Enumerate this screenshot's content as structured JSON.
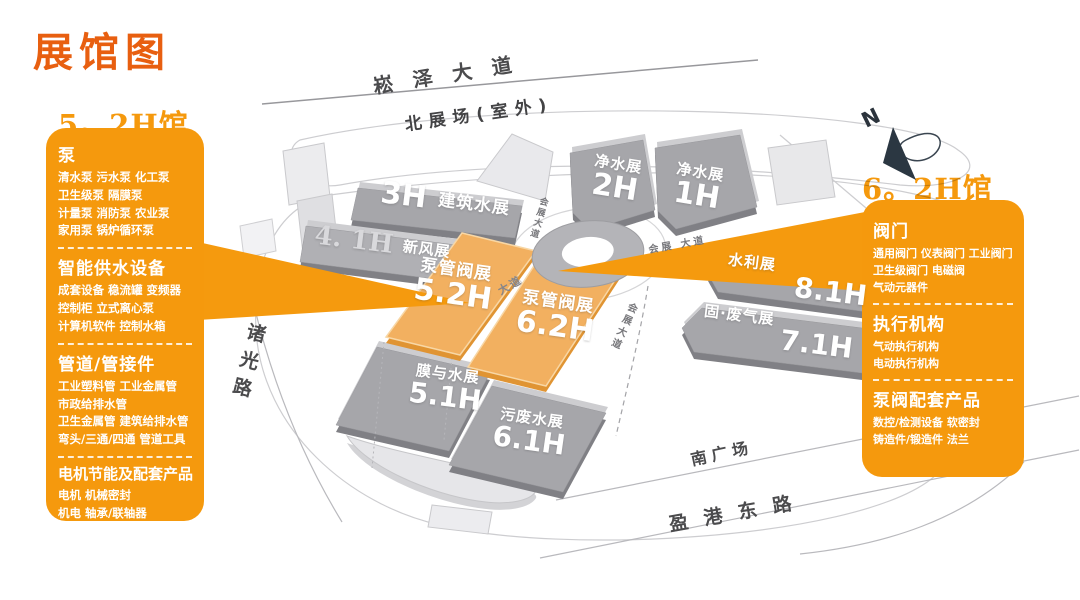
{
  "title": "展馆图",
  "colors": {
    "accent_orange": "#f5990d",
    "highlight_hall_orange": "#f2b060",
    "hall_gray": "#a6a6aa",
    "title_orange": "#e85f10"
  },
  "left_panel": {
    "heading": "5。2H馆",
    "sections": [
      {
        "header": "泵",
        "lines": [
          "清水泵 污水泵 化工泵",
          "卫生级泵 隔膜泵",
          "计量泵 消防泵 农业泵",
          "家用泵 锅炉循环泵"
        ]
      },
      {
        "header": "智能供水设备",
        "lines": [
          "成套设备 稳流罐 变频器",
          "控制柜 立式离心泵",
          "计算机软件 控制水箱"
        ]
      },
      {
        "header": "管道/管接件",
        "lines": [
          "工业塑料管 工业金属管",
          "市政给排水管",
          "卫生金属管 建筑给排水管",
          "弯头/三通/四通 管道工具"
        ]
      },
      {
        "header": "电机节能及配套产品",
        "lines": [
          "电机 机械密封",
          "机电 轴承/联轴器"
        ]
      }
    ]
  },
  "right_panel": {
    "heading": "6。2H馆",
    "sections": [
      {
        "header": "阀门",
        "lines": [
          "通用阀门 仪表阀门 工业阀门",
          "卫生级阀门 电磁阀",
          "气动元器件"
        ]
      },
      {
        "header": "执行机构",
        "lines": [
          "气动执行机构",
          "电动执行机构"
        ]
      },
      {
        "header": "泵阀配套产品",
        "lines": [
          "数控/检测设备 软密封",
          "铸造件/锻造件 法兰"
        ]
      }
    ]
  },
  "map": {
    "halls": [
      {
        "name": "净水展",
        "number": "2H",
        "highlight": false
      },
      {
        "name": "净水展",
        "number": "1H",
        "highlight": false
      },
      {
        "name": "建筑水展",
        "number": "3H",
        "highlight": false
      },
      {
        "name": "新风展",
        "number": "4. 1H",
        "highlight": false
      },
      {
        "name": "泵管阀展",
        "number": "5.2H",
        "highlight": true
      },
      {
        "name": "泵管阀展",
        "number": "6.2H",
        "highlight": true
      },
      {
        "name": "膜与水展",
        "number": "5.1H",
        "highlight": false
      },
      {
        "name": "污废水展",
        "number": "6.1H",
        "highlight": false
      },
      {
        "name": "水利展",
        "number": "8.1H",
        "highlight": false
      },
      {
        "name": "固·废气展",
        "number": "7.1H",
        "highlight": false
      }
    ],
    "roads": {
      "songze": "崧泽大道",
      "north_plaza": "北展场(室外)",
      "zhuguang": "诸光路",
      "south_plaza": "南广场",
      "yinggang": "盈港东路",
      "huizhan_nw": "会展大道",
      "huizhan_ne": "会展 大道",
      "huizhan_s": "会展大道",
      "dadao": "大道"
    },
    "compass": {
      "n": "N"
    }
  }
}
